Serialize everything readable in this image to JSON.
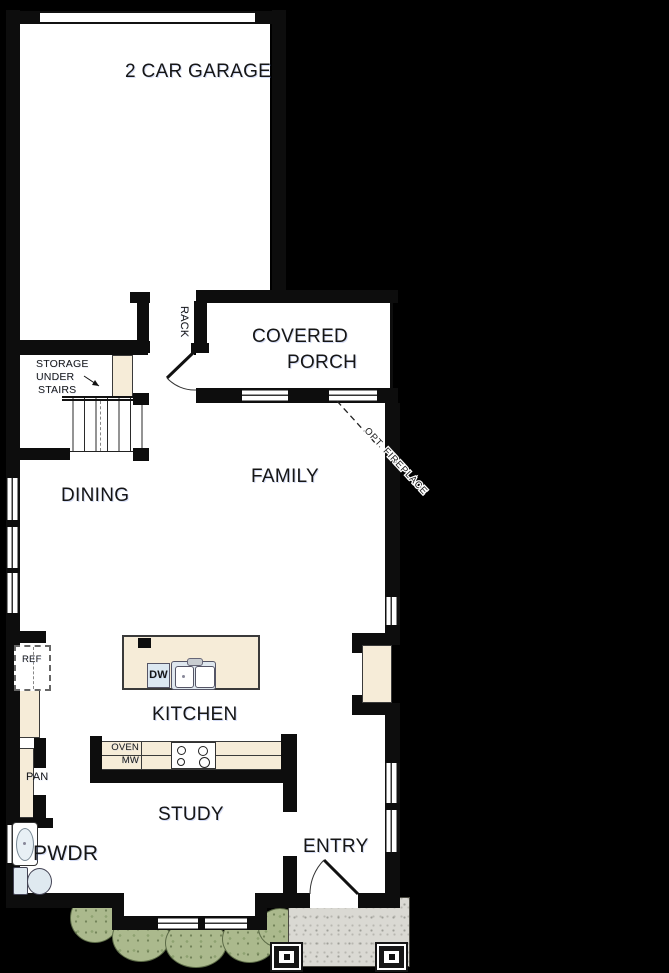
{
  "plan": {
    "rooms": {
      "garage": "2 CAR GARAGE",
      "covered_porch_line1": "COVERED",
      "covered_porch_line2": "PORCH",
      "dining": "DINING",
      "family": "FAMILY",
      "kitchen": "KITCHEN",
      "study": "STUDY",
      "entry": "ENTRY",
      "powder": "PWDR"
    },
    "annotations": {
      "storage_line1": "STORAGE",
      "storage_line2": "UNDER",
      "storage_line3": "STAIRS",
      "rack": "RACK",
      "opt_fireplace": "OPT. FIREPLACE",
      "ref": "REF",
      "pan": "PAN",
      "dw": "DW",
      "oven": "OVEN",
      "mw": "MW"
    },
    "colors": {
      "background": "#000000",
      "paper": "#ffffff",
      "wall": "#0d0d0d",
      "cabinetry_cream": "#f6ecd8",
      "fixture_blue": "#dce8f1",
      "landscape_green": "#abb98d",
      "concrete_gray": "#dad9d3"
    }
  }
}
